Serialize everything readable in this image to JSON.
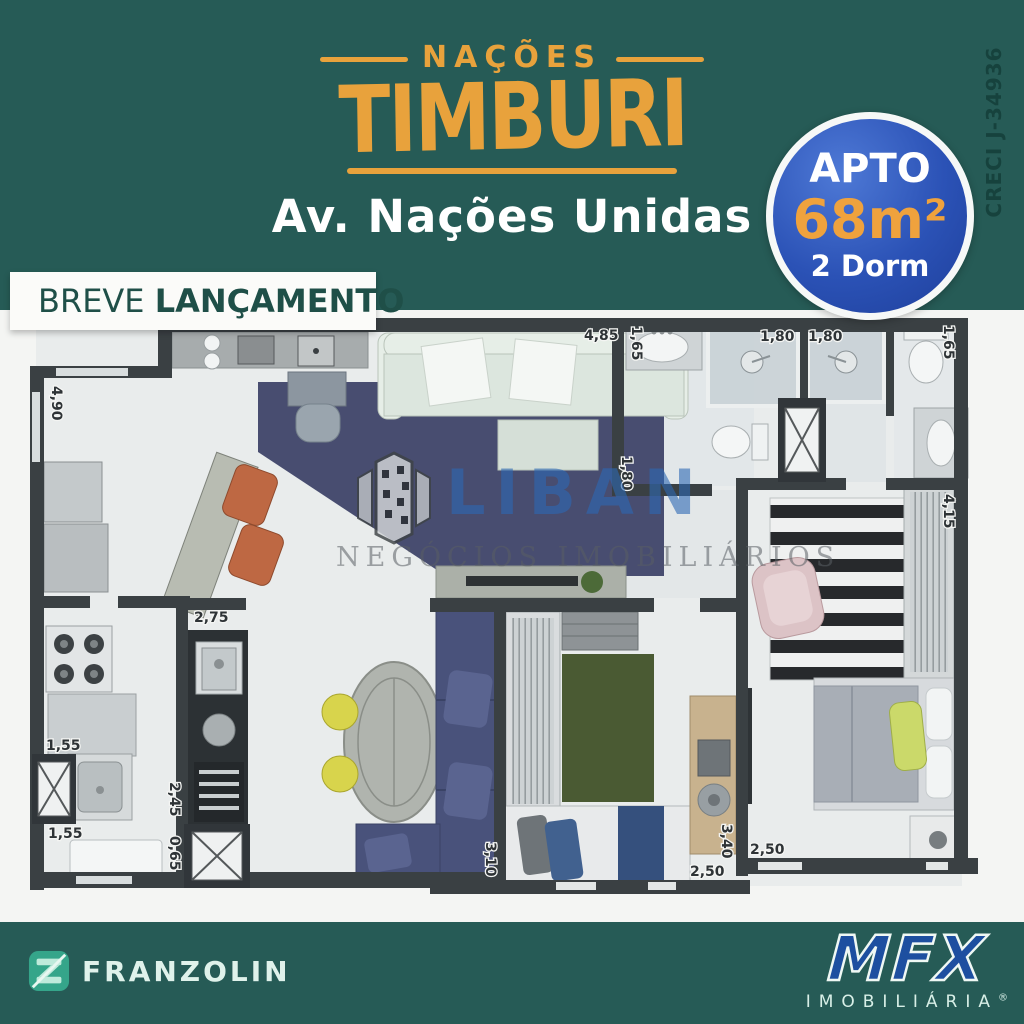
{
  "header": {
    "brand_top": "NAÇÕES",
    "brand_main": "TIMBURI",
    "address": "Av. Nações Unidas",
    "creci": "CRECI J-34936",
    "badge": {
      "apto": "APTO",
      "area": "68m²",
      "dorm": "2 Dorm"
    }
  },
  "banner": {
    "light": "BREVE ",
    "bold": "LANÇAMENTO"
  },
  "watermark": {
    "name": "LIBAN",
    "subtitle": "NEGÓCIOS IMOBILIÁRIOS"
  },
  "plan": {
    "dims": [
      "4,90",
      "4,85",
      "1,65",
      "1,80",
      "1,80",
      "1,65",
      "1,80",
      "4,15",
      "2,75",
      "1,55",
      "2,45",
      "0,65",
      "1,55",
      "3,10",
      "2,50",
      "3,40",
      "2,50"
    ]
  },
  "footer": {
    "franzolin": "FRANZOLIN",
    "mfx": "MFX",
    "mfx_sub": "IMOBILIÁRIA",
    "mfx_reg": "®"
  },
  "colors": {
    "teal_bg": "#265B56",
    "orange": "#E8A23C",
    "badge_blue": "#2B52B6",
    "banner_green": "#1F4F48",
    "mfx_blue": "#1D4FA0",
    "wall_gray": "#3A4043"
  }
}
